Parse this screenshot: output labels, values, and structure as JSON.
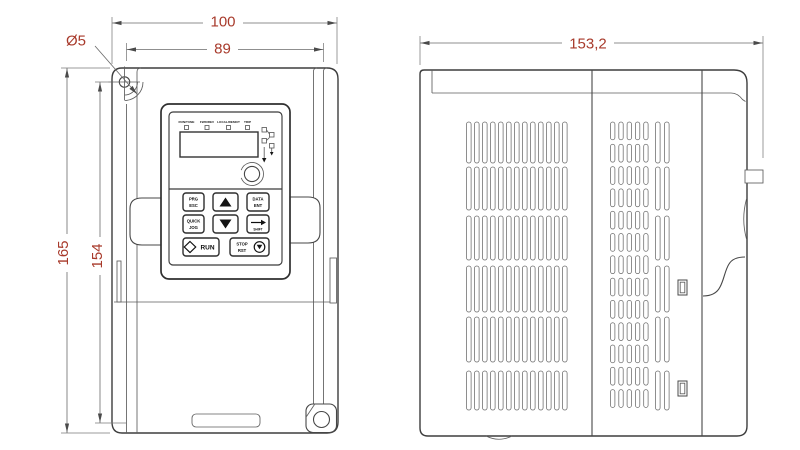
{
  "dimensions": {
    "front_width_outer": "100",
    "front_width_inner": "89",
    "mounting_hole_diameter": "Ø5",
    "front_height_outer": "165",
    "front_height_inner": "154",
    "side_depth": "153,2"
  },
  "keypad": {
    "led_labels": [
      "RUN/TUNE",
      "FWD/REV",
      "LOCAL/REMOT",
      "TRIP"
    ],
    "buttons": {
      "prg_line1": "PRG",
      "prg_line2": "ESC",
      "data_line1": "DATA",
      "data_line2": "ENT",
      "quick_line1": "QUICK",
      "quick_line2": "JOG",
      "shift_label": "SHIFT",
      "run_label": "RUN",
      "stop_line1": "STOP",
      "stop_line2": "RST"
    }
  },
  "colors": {
    "dimension_text": "#a83a2b",
    "line": "#4c4c4c",
    "background": "#ffffff"
  }
}
